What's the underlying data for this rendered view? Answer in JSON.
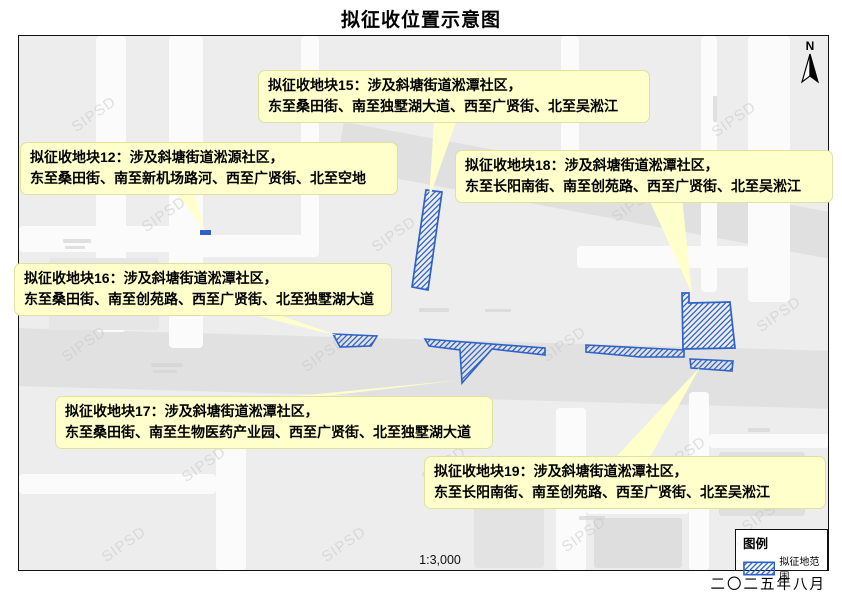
{
  "title": "拟征收位置示意图",
  "map": {
    "north_label": "N",
    "scale_text": "1:3,000",
    "watermark": "SIPSD"
  },
  "callouts": {
    "b12": {
      "line1": "拟征收地块12：涉及斜塘街道淞源社区，",
      "line2": "东至桑田街、南至新机场路河、西至广贤街、北至空地"
    },
    "b15": {
      "line1": "拟征收地块15：涉及斜塘街道淞潭社区，",
      "line2": "东至桑田街、南至独墅湖大道、西至广贤街、北至吴淞江"
    },
    "b16": {
      "line1": "拟征收地块16：涉及斜塘街道淞潭社区，",
      "line2": "东至桑田街、南至创苑路、西至广贤街、北至独墅湖大道"
    },
    "b17": {
      "line1": "拟征收地块17：涉及斜塘街道淞潭社区，",
      "line2": "东至桑田街、南至生物医药产业园、西至广贤街、北至独墅湖大道"
    },
    "b18": {
      "line1": "拟征收地块18：涉及斜塘街道淞潭社区，",
      "line2": "东至长阳南街、南至创苑路、西至广贤街、北至吴淞江"
    },
    "b19": {
      "line1": "拟征收地块19：涉及斜塘街道淞潭社区，",
      "line2": "东至长阳南街、南至创苑路、西至广贤街、北至吴淞江"
    }
  },
  "legend": {
    "title": "图例",
    "item_label": "拟征地范围"
  },
  "footer": {
    "date": "二〇二五年八月"
  },
  "colors": {
    "parcel_blue": "#2e62c8",
    "callout_fill": "#ffffcb"
  }
}
